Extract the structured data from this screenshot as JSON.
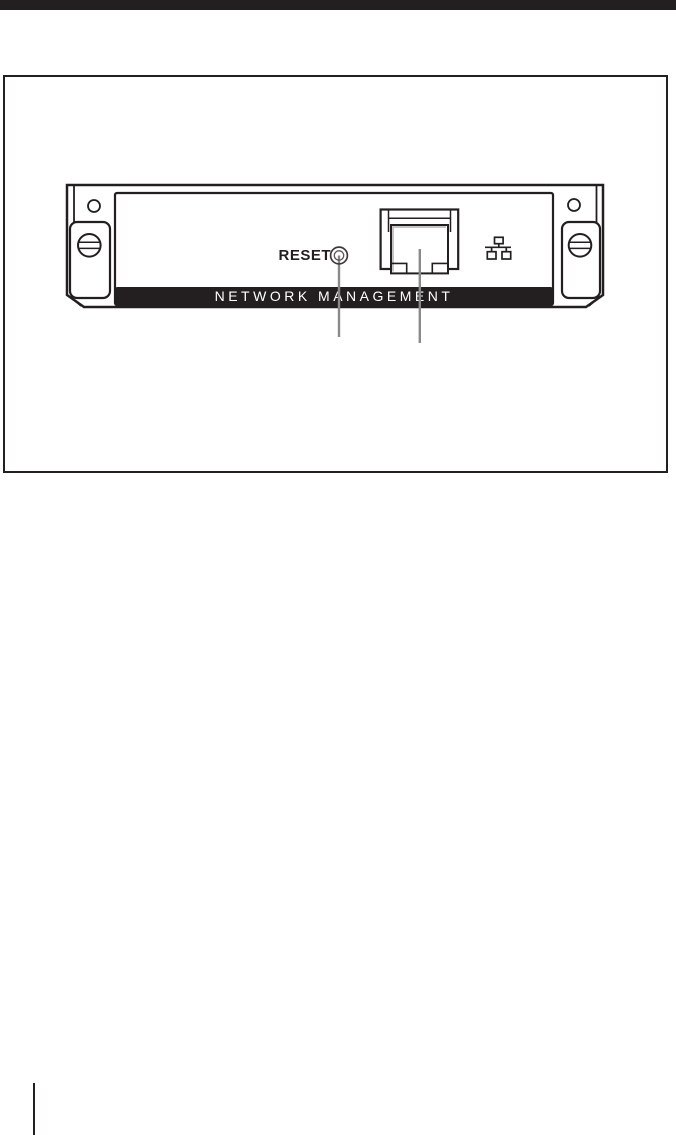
{
  "page": {
    "background": "#ffffff",
    "ink_color": "#231f20",
    "callout_color": "#8a8a8a",
    "port_accent_color": "#b3b3b3"
  },
  "top_bar": {
    "color": "#231f20"
  },
  "figure": {
    "strip_label": "NETWORK MANAGEMENT",
    "reset_label": "RESET",
    "icons": {
      "ethernet": "ethernet-lan-icon"
    },
    "callout_targets": [
      "reset-button",
      "ethernet-port"
    ]
  }
}
